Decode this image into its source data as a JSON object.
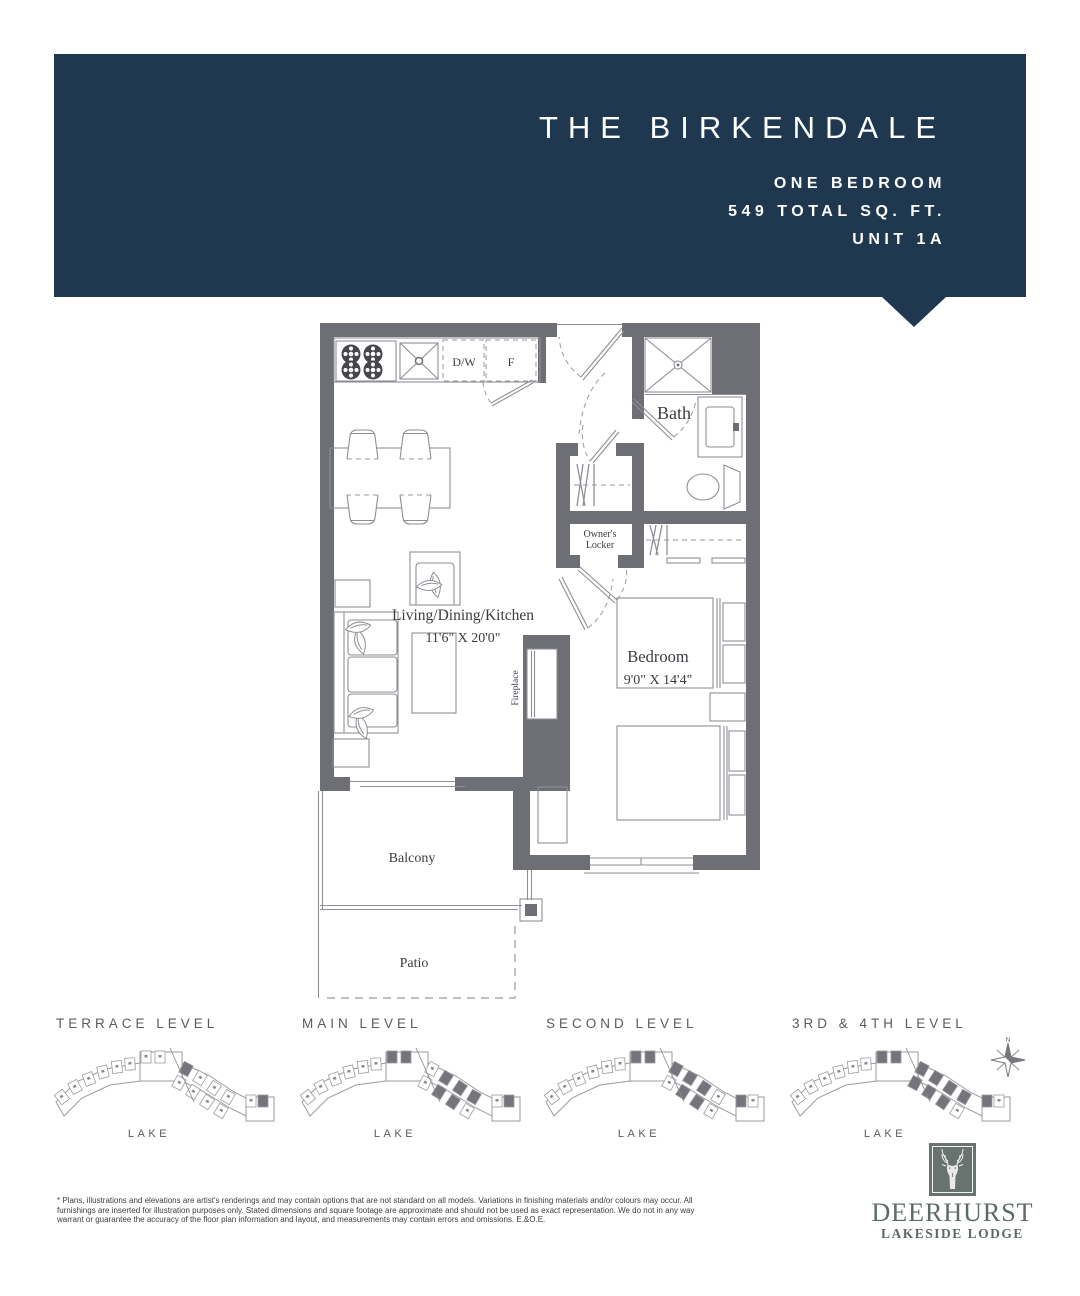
{
  "header": {
    "title": "THE BIRKENDALE",
    "unit_type": "ONE BEDROOM",
    "area": "549 TOTAL SQ. FT.",
    "unit_number": "UNIT 1A"
  },
  "floor_plan": {
    "labels": {
      "dishwasher": "D/W",
      "fridge": "F",
      "bath": "Bath",
      "owners_locker_line1": "Owner's",
      "owners_locker_line2": "Locker",
      "living_room": "Living/Dining/Kitchen",
      "living_dims": "11'6\" X 20'0\"",
      "fireplace": "Fireplace",
      "bedroom": "Bedroom",
      "bedroom_dims": "9'0\" X 14'4\"",
      "balcony": "Balcony",
      "patio": "Patio"
    }
  },
  "levels": [
    {
      "title": "TERRACE LEVEL",
      "lake": "LAKE"
    },
    {
      "title": "MAIN LEVEL",
      "lake": "LAKE"
    },
    {
      "title": "SECOND LEVEL",
      "lake": "LAKE"
    },
    {
      "title": "3RD & 4TH LEVEL",
      "lake": "LAKE"
    }
  ],
  "compass": {
    "north": "N"
  },
  "logo": {
    "brand": "DEERHURST",
    "tagline": "LAKESIDE LODGE"
  },
  "disclaimer": {
    "text": "* Plans, illustrations and elevations are artist's renderings and may contain options that are not standard on all models. Variations in finishing materials and/or colours may occur. All\nfurnishings are inserted for illustration purposes only. Stated dimensions and square footage are approximate and should not be used as exact representation. We do not in any way\nwarrant or guarantee the accuracy of the floor plan information and layout, and measurements may contain errors and omissions. E.&O.E."
  },
  "colors": {
    "navy": "#1f3850",
    "wall": "#6e6e75",
    "logo_green": "#68726e"
  }
}
